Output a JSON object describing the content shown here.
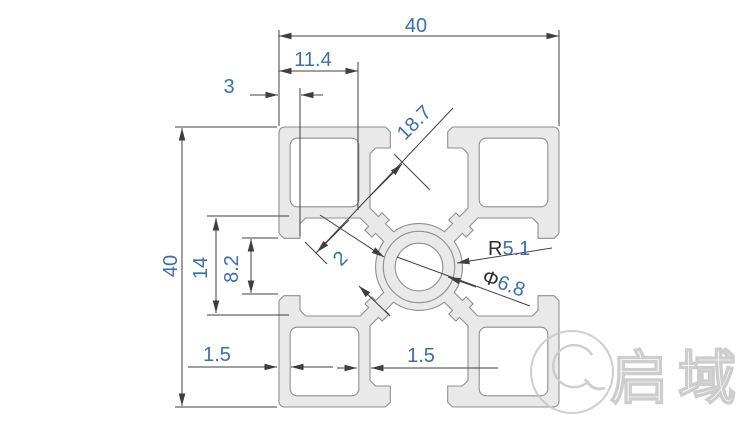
{
  "drawing": {
    "type": "technical-cross-section",
    "subject": "4040 aluminium extrusion profile",
    "dims": {
      "top_width": "40",
      "slot_offset": "11.4",
      "lip_depth": "3",
      "side_height": "40",
      "slot_inner_width": "14",
      "slot_opening": "8.2",
      "diagonal_across": "18.7",
      "web_thickness": "2",
      "boss_radius_prefix": "R",
      "boss_radius_value": "5.1",
      "hole_dia_prefix": "Φ",
      "hole_dia_value": "6.8",
      "wall_thickness_left": "1.5",
      "wall_thickness_inner": "1.5"
    },
    "watermark": {
      "brand": "启域"
    },
    "colors": {
      "dim_text": "#3a6db5",
      "dim_symbol": "#2f2f2f",
      "dim_line": "#3f3f3f",
      "profile_fill": "#e9e9e9",
      "profile_stroke": "#8f8f8f",
      "watermark": "#c8c8c8",
      "background": "#ffffff"
    }
  }
}
